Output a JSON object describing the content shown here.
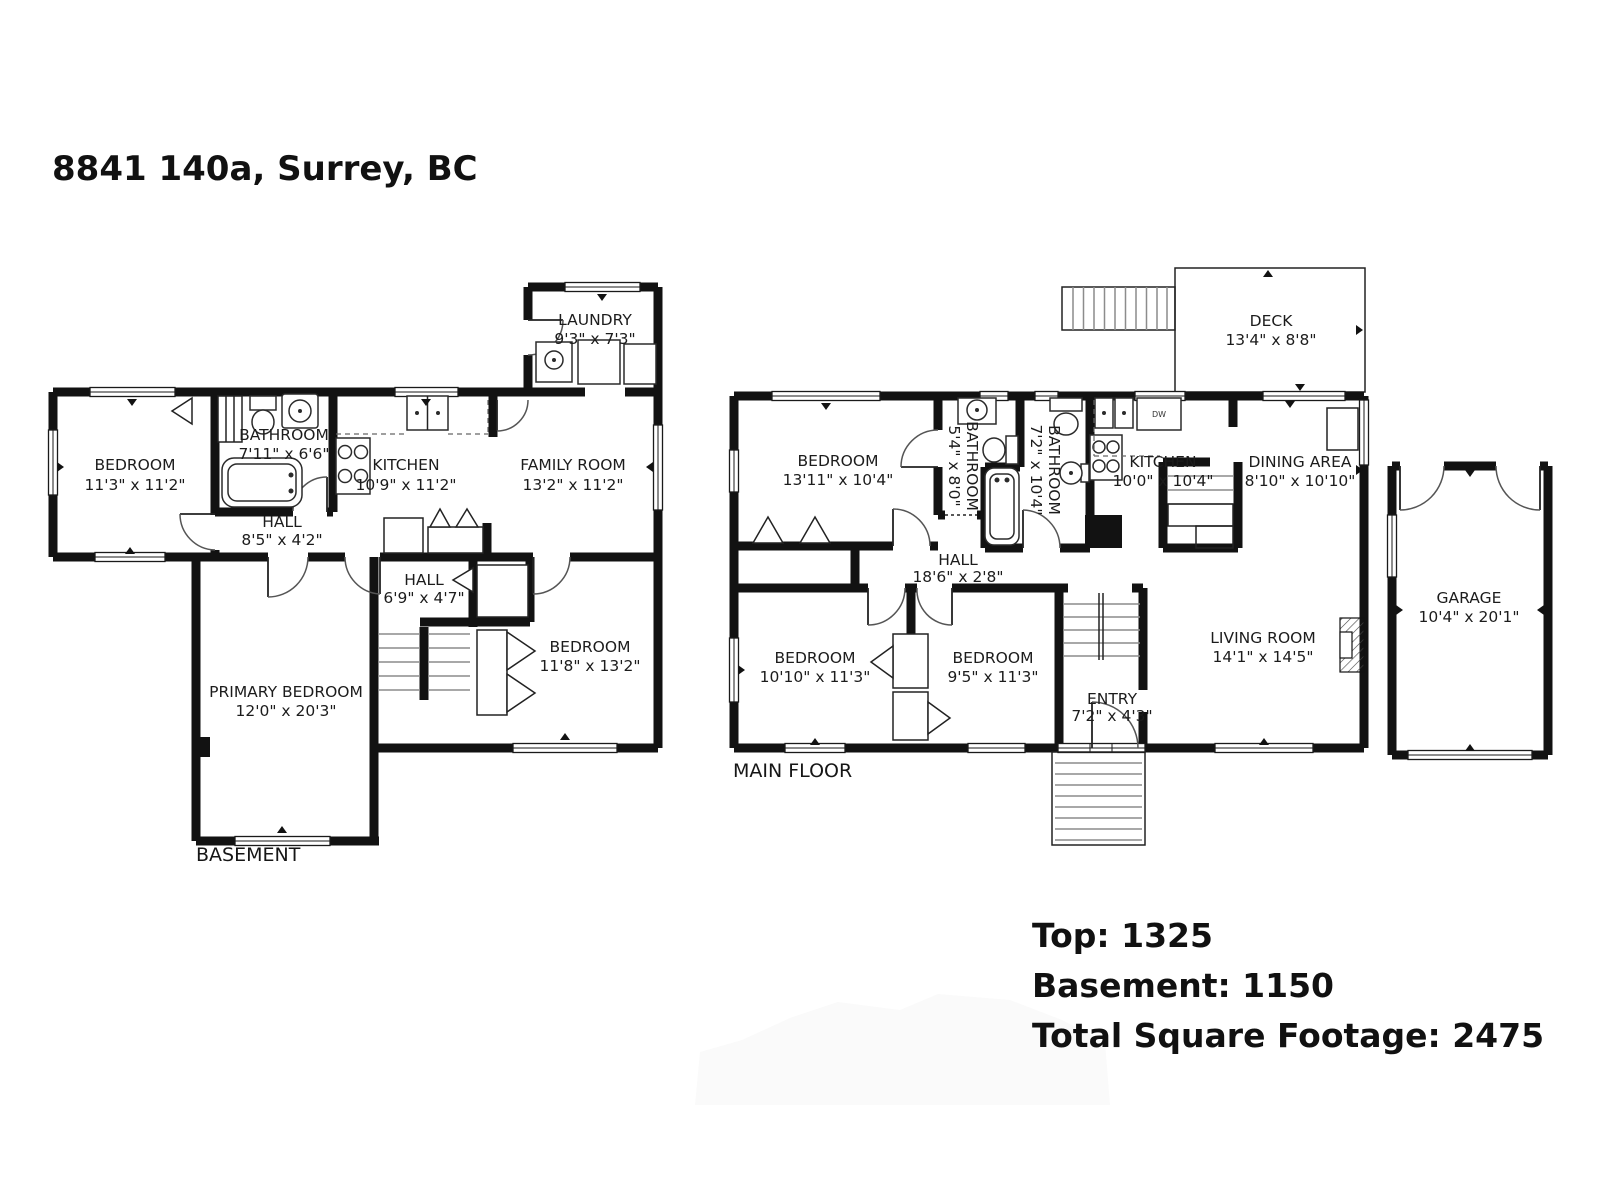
{
  "title": "8841 140a, Surrey, BC",
  "summary": {
    "top": "Top: 1325",
    "basement": "Basement: 1150",
    "total": "Total Square Footage: 2475"
  },
  "colors": {
    "wall": "#121212",
    "text": "#1c1c1c",
    "background": "#ffffff"
  },
  "floors": {
    "basement": {
      "label": "BASEMENT",
      "rooms": {
        "bedroom": {
          "name": "BEDROOM",
          "dims": "11'3\" x 11'2\""
        },
        "bathroom": {
          "name": "BATHROOM",
          "dims": "7'11\" x 6'6\""
        },
        "kitchen": {
          "name": "KITCHEN",
          "dims": "10'9\" x 11'2\""
        },
        "family_room": {
          "name": "FAMILY ROOM",
          "dims": "13'2\" x 11'2\""
        },
        "laundry": {
          "name": "LAUNDRY",
          "dims": "9'3\" x 7'3\""
        },
        "hall_upper": {
          "name": "HALL",
          "dims": "8'5\" x 4'2\""
        },
        "hall_lower": {
          "name": "HALL",
          "dims": "6'9\" x 4'7\""
        },
        "bedroom2": {
          "name": "BEDROOM",
          "dims": "11'8\" x 13'2\""
        },
        "primary_bedroom": {
          "name": "PRIMARY BEDROOM",
          "dims": "12'0\" x 20'3\""
        }
      }
    },
    "main": {
      "label": "MAIN FLOOR",
      "dw_label": "DW",
      "rooms": {
        "deck": {
          "name": "DECK",
          "dims": "13'4\" x 8'8\""
        },
        "bedroom1": {
          "name": "BEDROOM",
          "dims": "13'11\" x 10'4\""
        },
        "bathroom1": {
          "name": "BATHROOM",
          "dims": "5'4\" x 8'0\""
        },
        "bathroom2": {
          "name": "BATHROOM",
          "dims": "7'2\" x 10'4\""
        },
        "kitchen": {
          "name": "KITCHEN",
          "dims": "10'0\" x 10'4\""
        },
        "dining": {
          "name": "DINING AREA",
          "dims": "8'10\" x 10'10\""
        },
        "hall": {
          "name": "HALL",
          "dims": "18'6\" x 2'8\""
        },
        "bedroom2": {
          "name": "BEDROOM",
          "dims": "10'10\" x 11'3\""
        },
        "bedroom3": {
          "name": "BEDROOM",
          "dims": "9'5\" x 11'3\""
        },
        "entry": {
          "name": "ENTRY",
          "dims": "7'2\" x 4'3\""
        },
        "living": {
          "name": "LIVING ROOM",
          "dims": "14'1\" x 14'5\""
        },
        "garage": {
          "name": "GARAGE",
          "dims": "10'4\" x 20'1\""
        }
      }
    }
  }
}
